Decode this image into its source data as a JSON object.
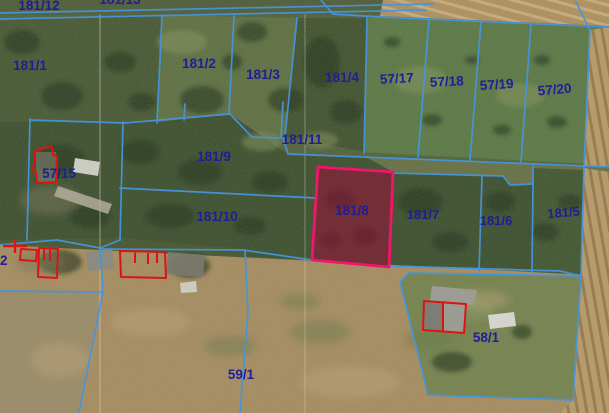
{
  "map": {
    "description": "Aerial cadastral parcel map with blue parcel boundaries, navy parcel number labels, red building outlines and one selected parcel highlighted in magenta",
    "highlighted_parcel": "181/8",
    "colors": {
      "boundary_line": "#4595dc",
      "label_text": "#1e1e96",
      "highlight_stroke": "#f1156b",
      "highlight_fill": "rgba(135,8,48,0.45)",
      "building_outline": "#dc1414"
    },
    "parcels": {
      "p181_12": "181/12",
      "p_top_clipped": "181/13",
      "p181_1": "181/1",
      "p181_2": "181/2",
      "p181_3": "181/3",
      "p181_4": "181/4",
      "p57_17": "57/17",
      "p57_18": "57/18",
      "p57_19": "57/19",
      "p57_20": "57/20",
      "p181_11": "181/11",
      "p181_9": "181/9",
      "p57_15": "57/15",
      "p181_10": "181/10",
      "p181_8": "181/8",
      "p181_7": "181/7",
      "p181_6": "181/6",
      "p181_5": "181/5",
      "p2": "2",
      "p59_1": "59/1",
      "p58_1": "58/1"
    }
  }
}
